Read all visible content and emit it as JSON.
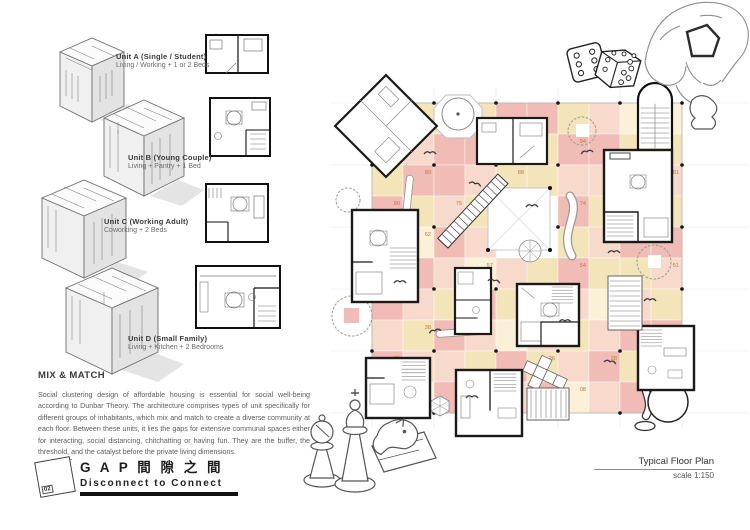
{
  "units": [
    {
      "title": "Unit A (Single / Student)",
      "desc": "Living / Working + 1 or 2 Beds"
    },
    {
      "title": "Unit B (Young Couple)",
      "desc": "Living + Pantry + 1 Bed"
    },
    {
      "title": "Unit C (Working Adult)",
      "desc": "Coworking + 2 Beds"
    },
    {
      "title": "Unit D (Small Family)",
      "desc": "Living + Kitchen + 2 Bedrooms"
    }
  ],
  "mix_match": {
    "heading": "MIX & MATCH",
    "body": "Social clustering design of affordable housing is essential for social well-being according to Dunbar Theory. The architecture comprises types of unit specifically for different groups of inhabitants, which mix and match to create a diverse community at each floor. Between these units, it lies the gaps for extensive communal spaces either for interacting, social distancing, chitchatting or having fun. They are the buffer, the threshold, and the catalyst before the private living dimensions."
  },
  "logo": {
    "badge": "02",
    "title": "G A P  間 隙 之 間",
    "subtitle": "Disconnect to Connect"
  },
  "plan": {
    "caption": "Typical Floor Plan",
    "scale": "scale 1:150",
    "colors": {
      "P": "#f1bcb5",
      "S": "#f8dacd",
      "C": "#f3e4ba",
      "L": "#fbf1d8",
      "W": "#ffffff"
    },
    "grid": {
      "left": 372,
      "top": 103,
      "cell": 31,
      "cols": 10,
      "rows": 10,
      "pattern": [
        "WCCCPPCSLL",
        "SSPPSCPPCC",
        "CPPSCCSSPS",
        "PCSCWWPCSC",
        "SLPSWWCSPP",
        "CPSLSCPCCS",
        "PSCPCPSLSC",
        "SCPSLSCSPP",
        "PSSCPCSPCL",
        "CLPSSPLSPS"
      ]
    },
    "numbers": [
      {
        "n": "97",
        "c": 3,
        "r": 1
      },
      {
        "n": "94",
        "c": 6,
        "r": 1
      },
      {
        "n": "91",
        "c": 8,
        "r": 1
      },
      {
        "n": "80",
        "c": 1,
        "r": 2
      },
      {
        "n": "88",
        "c": 4,
        "r": 2
      },
      {
        "n": "81",
        "c": 9,
        "r": 2
      },
      {
        "n": "90",
        "c": 0,
        "r": 3
      },
      {
        "n": "75",
        "c": 2,
        "r": 3
      },
      {
        "n": "74",
        "c": 6,
        "r": 3
      },
      {
        "n": "62",
        "c": 1,
        "r": 4
      },
      {
        "n": "66",
        "c": 7,
        "r": 4
      },
      {
        "n": "57",
        "c": 3,
        "r": 5
      },
      {
        "n": "54",
        "c": 6,
        "r": 5
      },
      {
        "n": "51",
        "c": 9,
        "r": 5
      },
      {
        "n": "43",
        "c": 2,
        "r": 6
      },
      {
        "n": "46",
        "c": 5,
        "r": 6
      },
      {
        "n": "48",
        "c": 7,
        "r": 6
      },
      {
        "n": "38",
        "c": 1,
        "r": 7
      },
      {
        "n": "36",
        "c": 4,
        "r": 7
      },
      {
        "n": "31",
        "c": 9,
        "r": 7
      },
      {
        "n": "21",
        "c": 0,
        "r": 8
      },
      {
        "n": "26",
        "c": 5,
        "r": 8
      },
      {
        "n": "28",
        "c": 7,
        "r": 8
      },
      {
        "n": "03",
        "c": 2,
        "r": 9
      },
      {
        "n": "08",
        "c": 6,
        "r": 9
      },
      {
        "n": "12",
        "c": 8,
        "r": 9
      },
      {
        "n": "10",
        "c": 9,
        "r": 9
      }
    ],
    "number_color": "#c0763b"
  }
}
